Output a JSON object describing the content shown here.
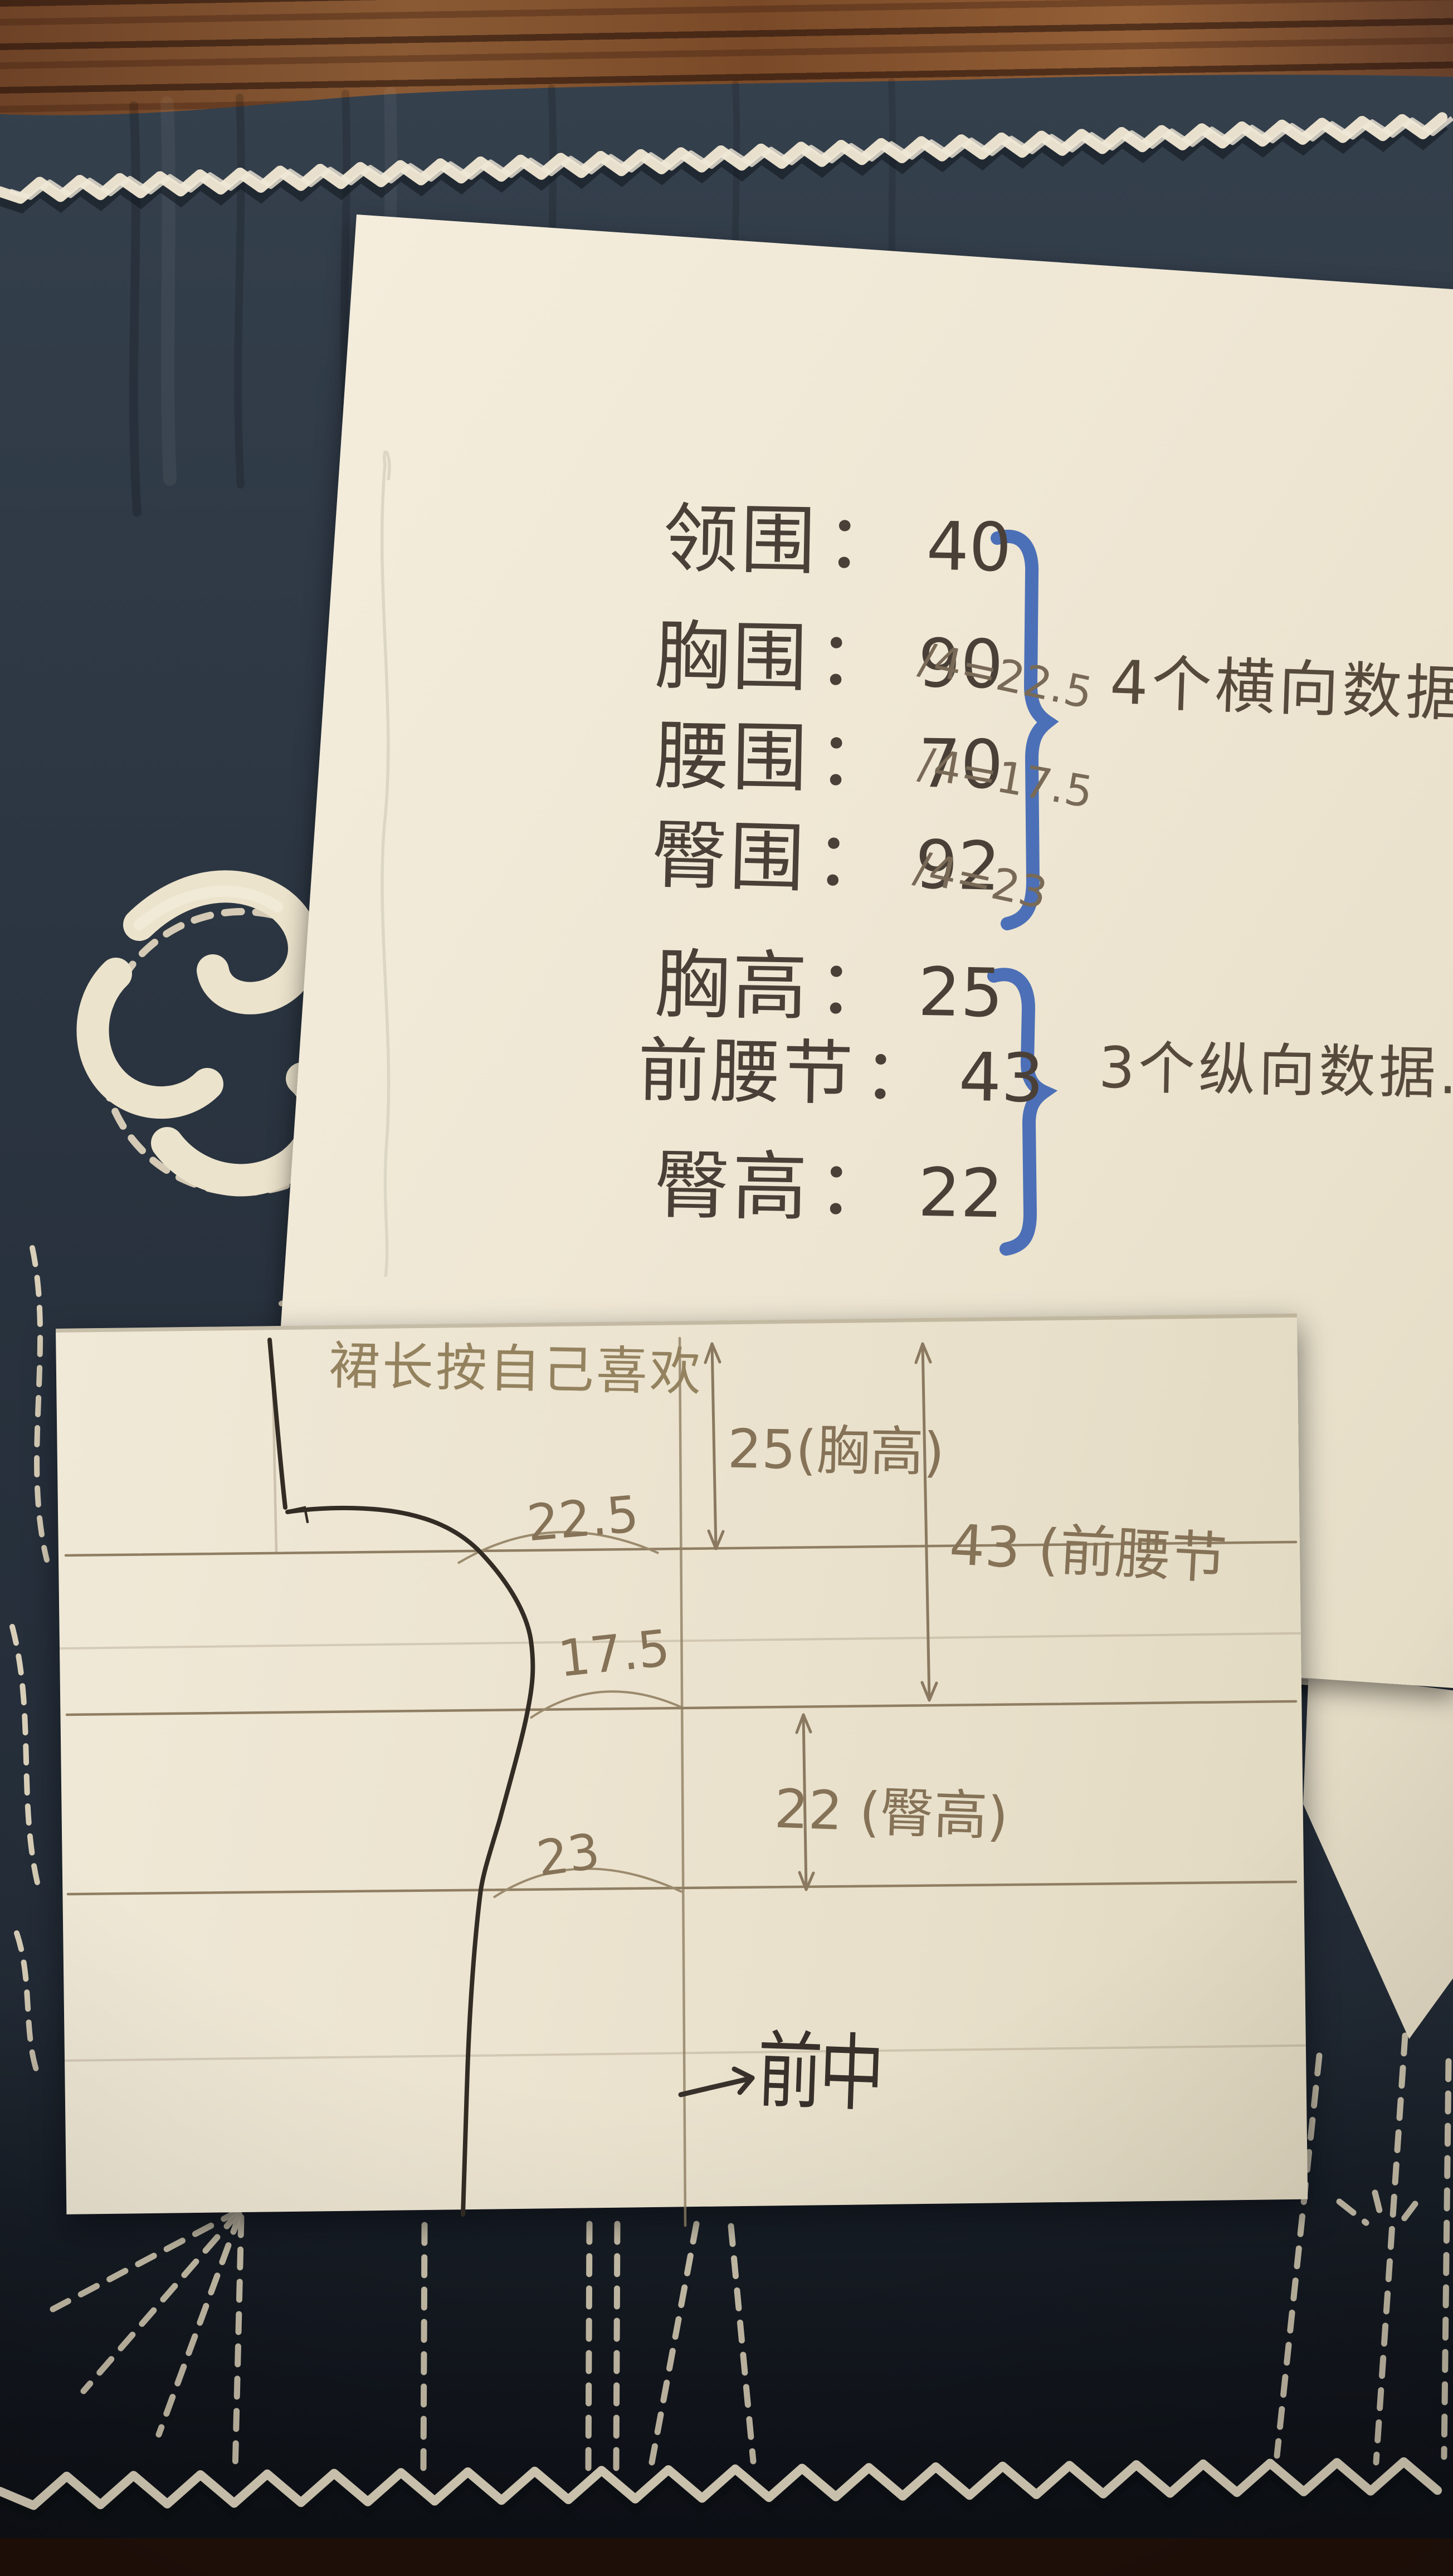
{
  "notes": {
    "lines": [
      {
        "label": "领围",
        "colon": "：",
        "value": "40",
        "calc": ""
      },
      {
        "label": "胸围",
        "colon": "：",
        "value": "90",
        "calc": "/4=22.5"
      },
      {
        "label": "腰围",
        "colon": "：",
        "value": "70",
        "calc": "/4=17.5"
      },
      {
        "label": "臀围",
        "colon": "：",
        "value": "92",
        "calc": "/4=23"
      },
      {
        "label": "胸高",
        "colon": "：",
        "value": "25",
        "calc": ""
      },
      {
        "label": "前腰节",
        "colon": "：",
        "value": "43",
        "calc": ""
      },
      {
        "label": "臀高",
        "colon": "：",
        "value": "22",
        "calc": ""
      }
    ],
    "group_horizontal": "4个横向数据",
    "group_vertical": "3个纵向数据."
  },
  "pattern": {
    "top_note": "裙长按自己喜欢",
    "bust_width": "22.5",
    "waist_width": "17.5",
    "hip_width": "23",
    "bust_height": "25(胸高)",
    "front_waist": "43 (前腰节",
    "hip_height": "22 (臀高)",
    "center_front": "前中"
  },
  "colors": {
    "marker_blue": "#4066b5",
    "fabric_navy": "#2b3541",
    "paper_cream": "#efe7d4",
    "wood_brown": "#7a4c2c",
    "ink_dark": "#4a4037",
    "pencil": "#857257"
  }
}
